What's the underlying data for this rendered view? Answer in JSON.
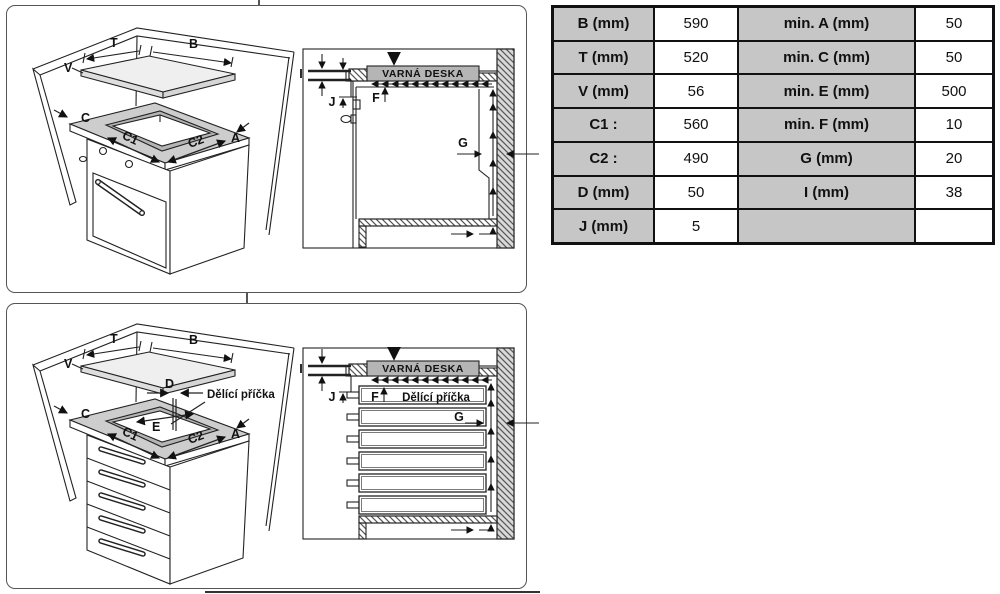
{
  "table": {
    "rows": [
      [
        "B (mm)",
        "590",
        "min. A (mm)",
        "50"
      ],
      [
        "T (mm)",
        "520",
        "min. C (mm)",
        "50"
      ],
      [
        "V (mm)",
        "56",
        "min. E (mm)",
        "500"
      ],
      [
        "C1 :",
        "560",
        "min. F (mm)",
        "10"
      ],
      [
        "C2 :",
        "490",
        "G (mm)",
        "20"
      ],
      [
        "D (mm)",
        "50",
        "I (mm)",
        "38"
      ],
      [
        "J (mm)",
        "5",
        "",
        ""
      ]
    ]
  },
  "panel1": {
    "iso": {
      "V": "V",
      "T": "T",
      "B": "B",
      "C": "C",
      "A": "A",
      "C1": "C1",
      "C2": "C2"
    },
    "section": {
      "cooktop": "VARNÁ DESKA",
      "I": "I",
      "J": "J",
      "F": "F",
      "G": "G"
    }
  },
  "panel2": {
    "iso": {
      "V": "V",
      "T": "T",
      "B": "B",
      "C": "C",
      "A": "A",
      "C1": "C1",
      "C2": "C2",
      "D": "D",
      "E": "E",
      "partition": "Dělící příčka"
    },
    "section": {
      "cooktop": "VARNÁ DESKA",
      "partition": "Dělící příčka",
      "I": "I",
      "J": "J",
      "F": "F",
      "G": "G"
    }
  },
  "colors": {
    "table_header_bg": "#c6c6c6",
    "line": "#222222",
    "cooktop_bar_bg": "#b5b5b5",
    "wall_fill": "#d9d9d9"
  }
}
